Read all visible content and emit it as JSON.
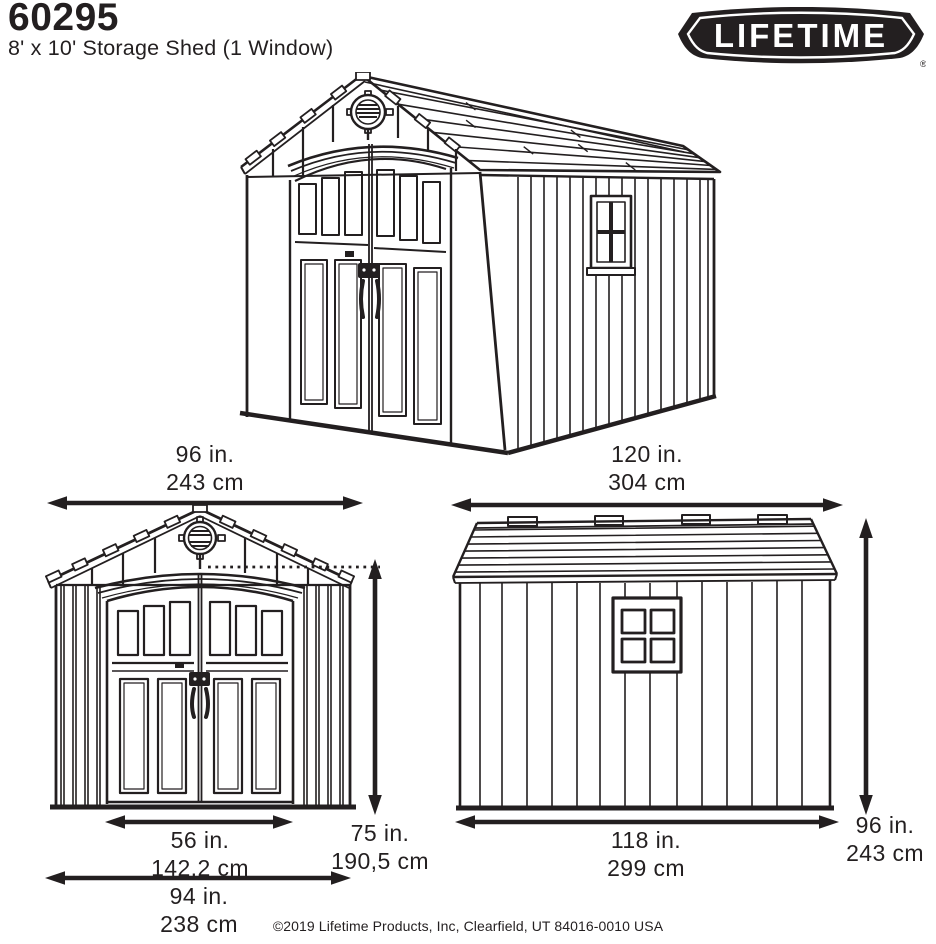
{
  "header": {
    "model_number": "60295",
    "product_title": "8' x 10' Storage Shed (1 Window)"
  },
  "brand": {
    "name": "LIFETIME",
    "registered_mark": "®"
  },
  "dimensions": {
    "front_overall_width": {
      "inches": "96 in.",
      "metric": "243 cm"
    },
    "door_opening_width": {
      "inches": "56 in.",
      "metric": "142,2 cm"
    },
    "front_base_width": {
      "inches": "94 in.",
      "metric": "238 cm"
    },
    "door_height": {
      "inches": "75 in.",
      "metric": "190,5 cm"
    },
    "side_overall_length": {
      "inches": "120 in.",
      "metric": "304 cm"
    },
    "side_base_length": {
      "inches": "118 in.",
      "metric": "299 cm"
    },
    "overall_height": {
      "inches": "96 in.",
      "metric": "243 cm"
    }
  },
  "footer": {
    "copyright": "©2019 Lifetime Products, Inc, Clearfield, UT 84016-0010 USA"
  },
  "colors": {
    "ink": "#231f20",
    "paper": "#ffffff"
  }
}
